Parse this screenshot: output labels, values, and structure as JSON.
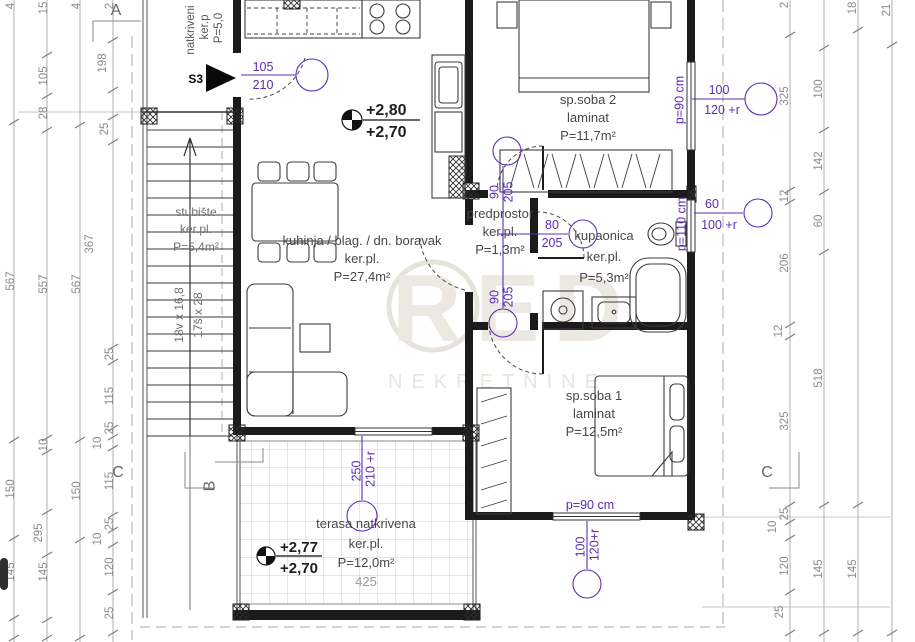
{
  "colors": {
    "annotation": "#5b2db5",
    "dimension": "#8b8b8b",
    "wall": "#1b1b1b",
    "watermark": "#ece9e3"
  },
  "watermark": {
    "brand": "RED",
    "subtitle": "NEKRETNINE"
  },
  "markers": {
    "a": "A",
    "b": "B",
    "c_left": "C",
    "c_right": "C",
    "s3": "S3"
  },
  "porch": {
    "line1": "natkriveni",
    "line2": "ker.p",
    "line3": "P=5,0"
  },
  "rooms": {
    "living": {
      "name": "kuhinja / blag. / dn. boravak",
      "floor": "ker.pl.",
      "area": "P=27,4m²"
    },
    "bedroom2": {
      "name": "sp.soba 2",
      "floor": "laminat",
      "area": "P=11,7m²"
    },
    "hall": {
      "name": "predprostor",
      "floor": "ker.pl.",
      "area": "P=1,3m²"
    },
    "bathroom": {
      "name": "kupaonica",
      "floor": "ker.pl.",
      "area": "P=5,3m²"
    },
    "bedroom1": {
      "name": "sp.soba 1",
      "floor": "laminat",
      "area": "P=12,5m²"
    },
    "terrace": {
      "name": "terasa natkrivena",
      "floor": "ker.pl.",
      "area": "P=12,0m²",
      "width": "425"
    },
    "stairs": {
      "name": "stubište",
      "floor": "ker.pl.",
      "area": "P=5,4m²",
      "risers": "18v x 16,8",
      "treads": "17š x 28"
    }
  },
  "elevations": {
    "living": {
      "top": "+2,80",
      "bottom": "+2,70"
    },
    "terrace": {
      "top": "+2,77",
      "bottom": "+2,70"
    }
  },
  "openings": {
    "entry_door": {
      "w": "105",
      "h": "210"
    },
    "bedroom2_window": {
      "w": "100",
      "h": "120 +r",
      "sill": "p=90 cm"
    },
    "bathroom_window": {
      "w": "60",
      "h": "100 +r",
      "sill": "p=110 cm"
    },
    "bedroom2_door": {
      "w": "90",
      "h": "205"
    },
    "bathroom_door": {
      "w": "80",
      "h": "205"
    },
    "bedroom1_door": {
      "w": "90",
      "h": "205"
    },
    "terrace_door": {
      "w": "250",
      "h": "210 +r"
    },
    "bedroom1_window": {
      "w": "100",
      "h": "120+r",
      "sill": "p=90 cm"
    }
  },
  "dims": {
    "l1": [
      "4",
      "567",
      "150",
      "145"
    ],
    "l2": [
      "15",
      "105",
      "28",
      "557",
      "10",
      "295",
      "145"
    ],
    "l3": [
      "4",
      "567",
      "150"
    ],
    "l4": [
      "2",
      "198",
      "25",
      "367",
      "25",
      "115",
      "25",
      "10",
      "115",
      "25",
      "10",
      "120",
      "25"
    ],
    "r1": [
      "2",
      "325",
      "12",
      "206",
      "12",
      "325",
      "25",
      "10",
      "120",
      "25"
    ],
    "r2": [
      "100",
      "142",
      "60",
      "518",
      "145"
    ],
    "r3": [
      "18",
      "145"
    ],
    "r4": [
      "21"
    ]
  }
}
